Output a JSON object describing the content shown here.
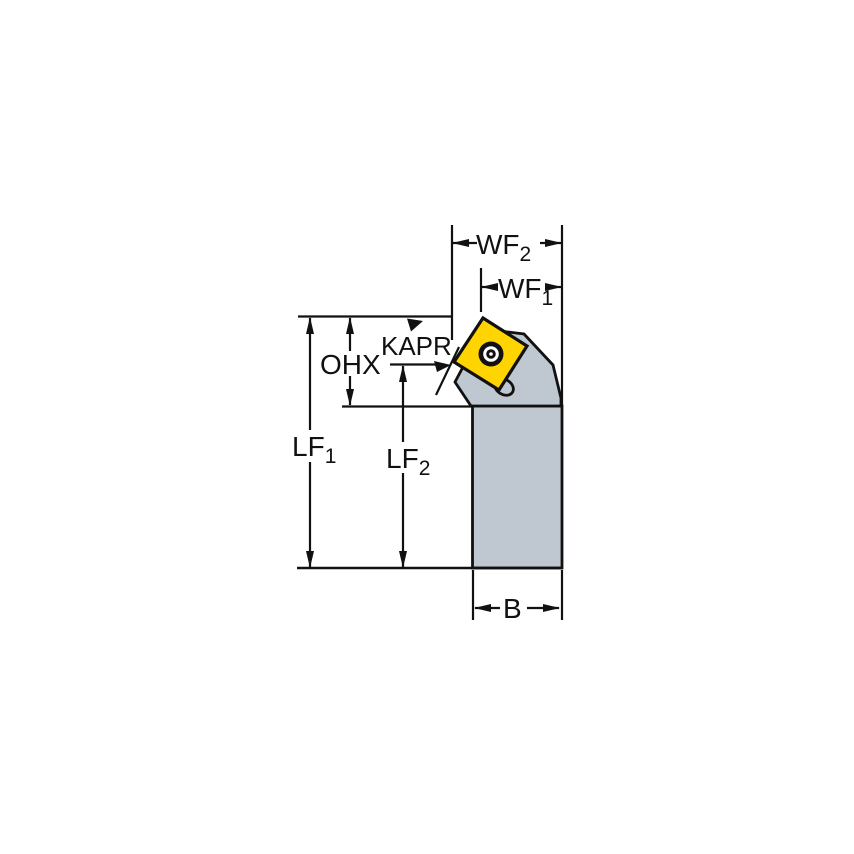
{
  "figure": {
    "type": "technical-drawing",
    "description": "Side view of a turning tool holder with square insert and dimension callouts",
    "labels": {
      "wf2": {
        "main": "WF",
        "sub": "2"
      },
      "wf1": {
        "main": "WF",
        "sub": "1"
      },
      "kapr": "KAPR",
      "ohx": "OHX",
      "lf1": {
        "main": "LF",
        "sub": "1"
      },
      "lf2": {
        "main": "LF",
        "sub": "2"
      },
      "b": "B"
    },
    "colors": {
      "background": "#ffffff",
      "line_black": "#111111",
      "body_gray": "#bfc8d0",
      "insert_yellow": "#ffd400"
    }
  }
}
